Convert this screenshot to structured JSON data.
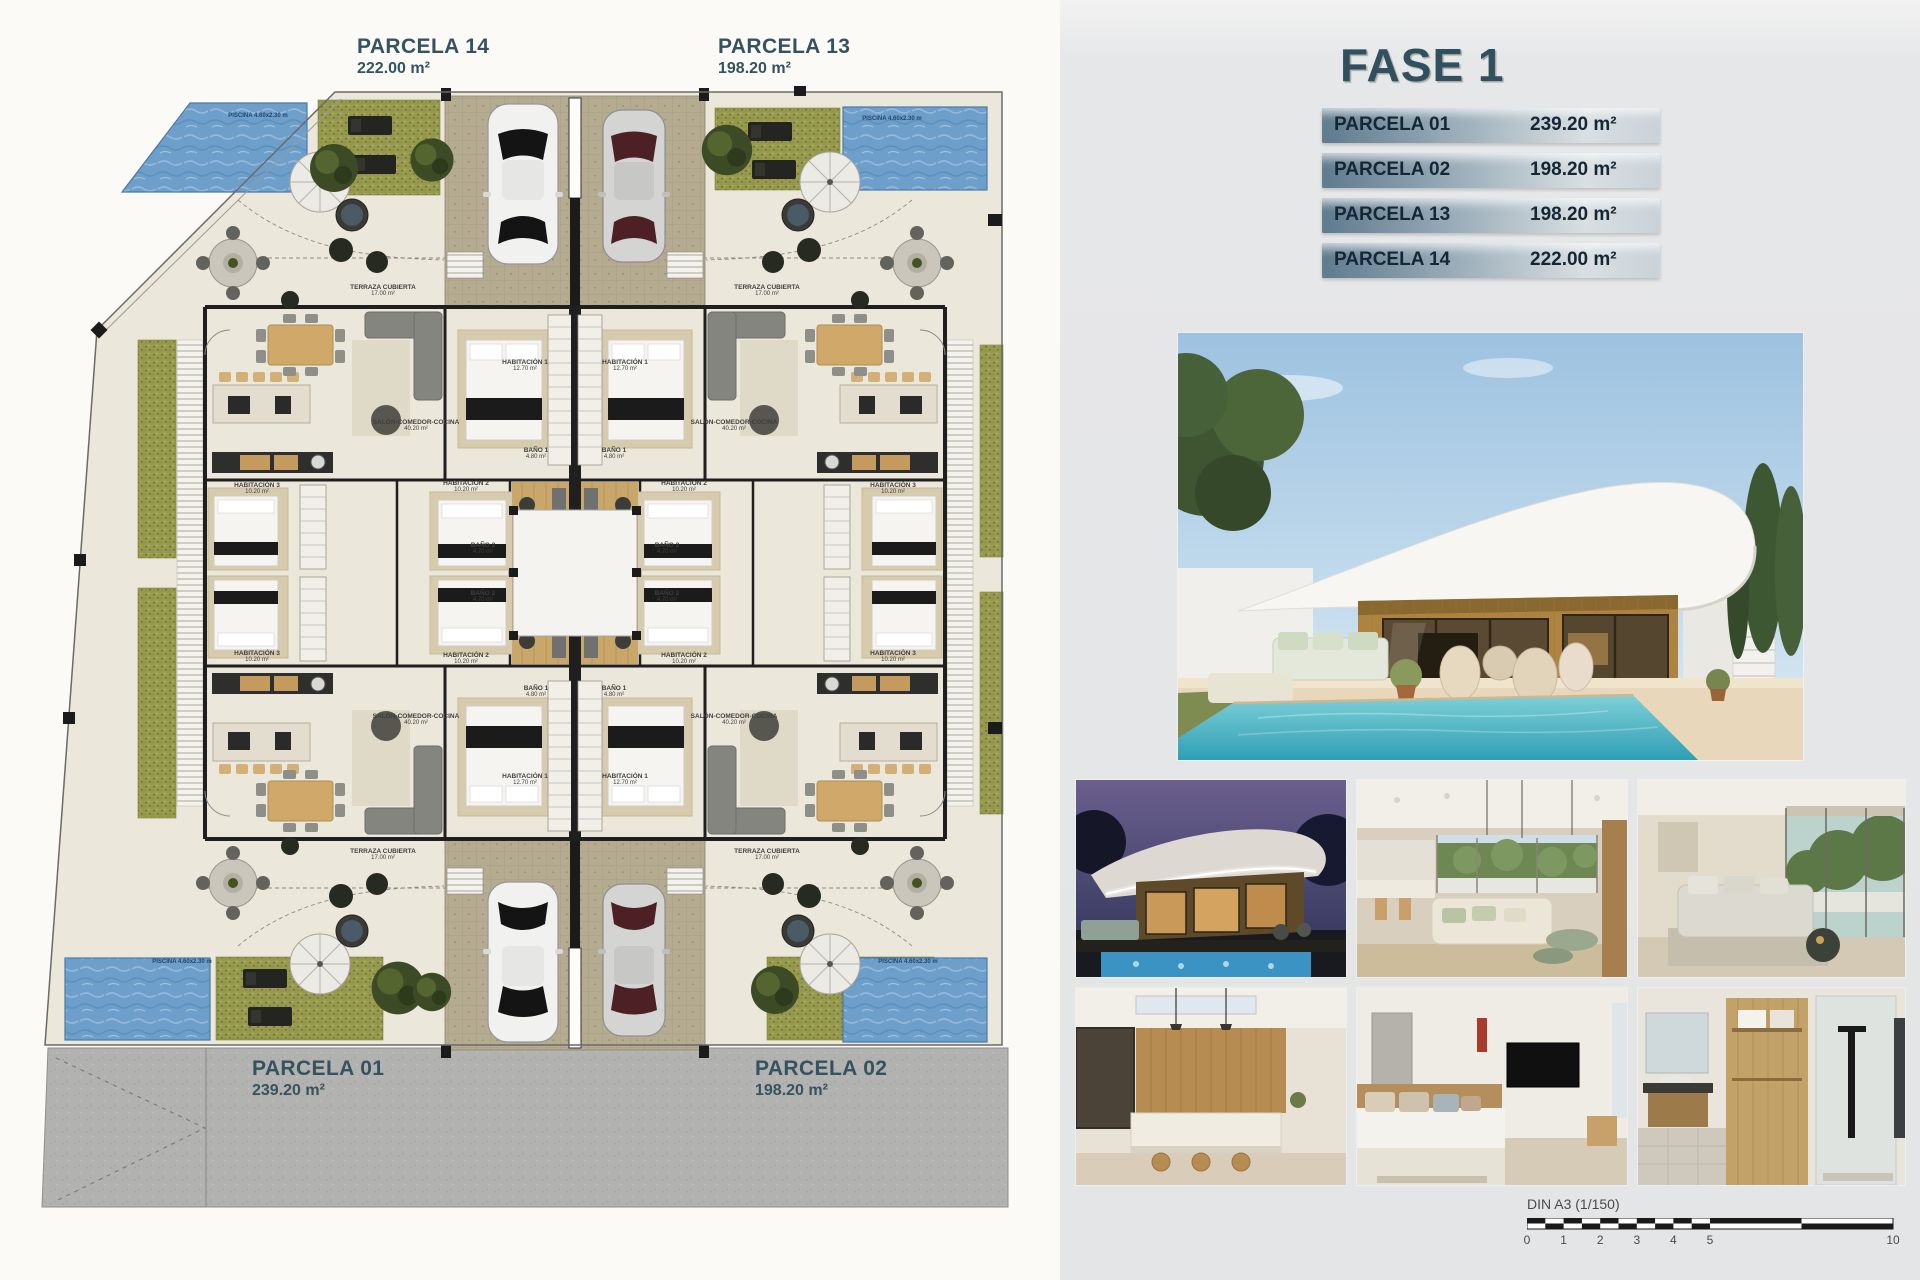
{
  "plan": {
    "top_labels": [
      {
        "name": "PARCELA 14",
        "area": "222.00 m²"
      },
      {
        "name": "PARCELA 13",
        "area": "198.20 m²"
      }
    ],
    "bottom_labels": [
      {
        "name": "PARCELA 01",
        "area": "239.20 m²"
      },
      {
        "name": "PARCELA 02",
        "area": "198.20 m²"
      }
    ],
    "pool_label": "PISCINA 4.60x2.30 m",
    "rooms": {
      "terraza": {
        "name": "TERRAZA CUBIERTA",
        "area": "17.00 m²"
      },
      "salon": {
        "name": "SALÓN-COMEDOR-COCINA",
        "area": "40.20 m²"
      },
      "hab1": {
        "name": "HABITACIÓN 1",
        "area": "12.70 m²"
      },
      "hab2": {
        "name": "HABITACIÓN 2",
        "area": "10.20 m²"
      },
      "hab3": {
        "name": "HABITACIÓN 3",
        "area": "10.20 m²"
      },
      "bano1": {
        "name": "BAÑO 1",
        "area": "4.80 m²"
      },
      "bano2": {
        "name": "BAÑO 2",
        "area": "4.70 m²"
      }
    }
  },
  "panel": {
    "title": "FASE 1",
    "table": [
      {
        "name": "PARCELA 01",
        "area": "239.20 m²"
      },
      {
        "name": "PARCELA 02",
        "area": "198.20 m²"
      },
      {
        "name": "PARCELA 13",
        "area": "198.20 m²"
      },
      {
        "name": "PARCELA 14",
        "area": "222.00 m²"
      }
    ]
  },
  "scalebar": {
    "label": "DIN A3 (1/150)",
    "ticks": [
      "0",
      "1",
      "2",
      "3",
      "4",
      "5",
      "10"
    ]
  },
  "colors": {
    "accent": "#35535f",
    "row_dark": "#5f7a8e",
    "row_light": "#d9dfe2",
    "pool": "#6d9fca",
    "grass": "#97994e",
    "street": "#b2b2b0"
  }
}
